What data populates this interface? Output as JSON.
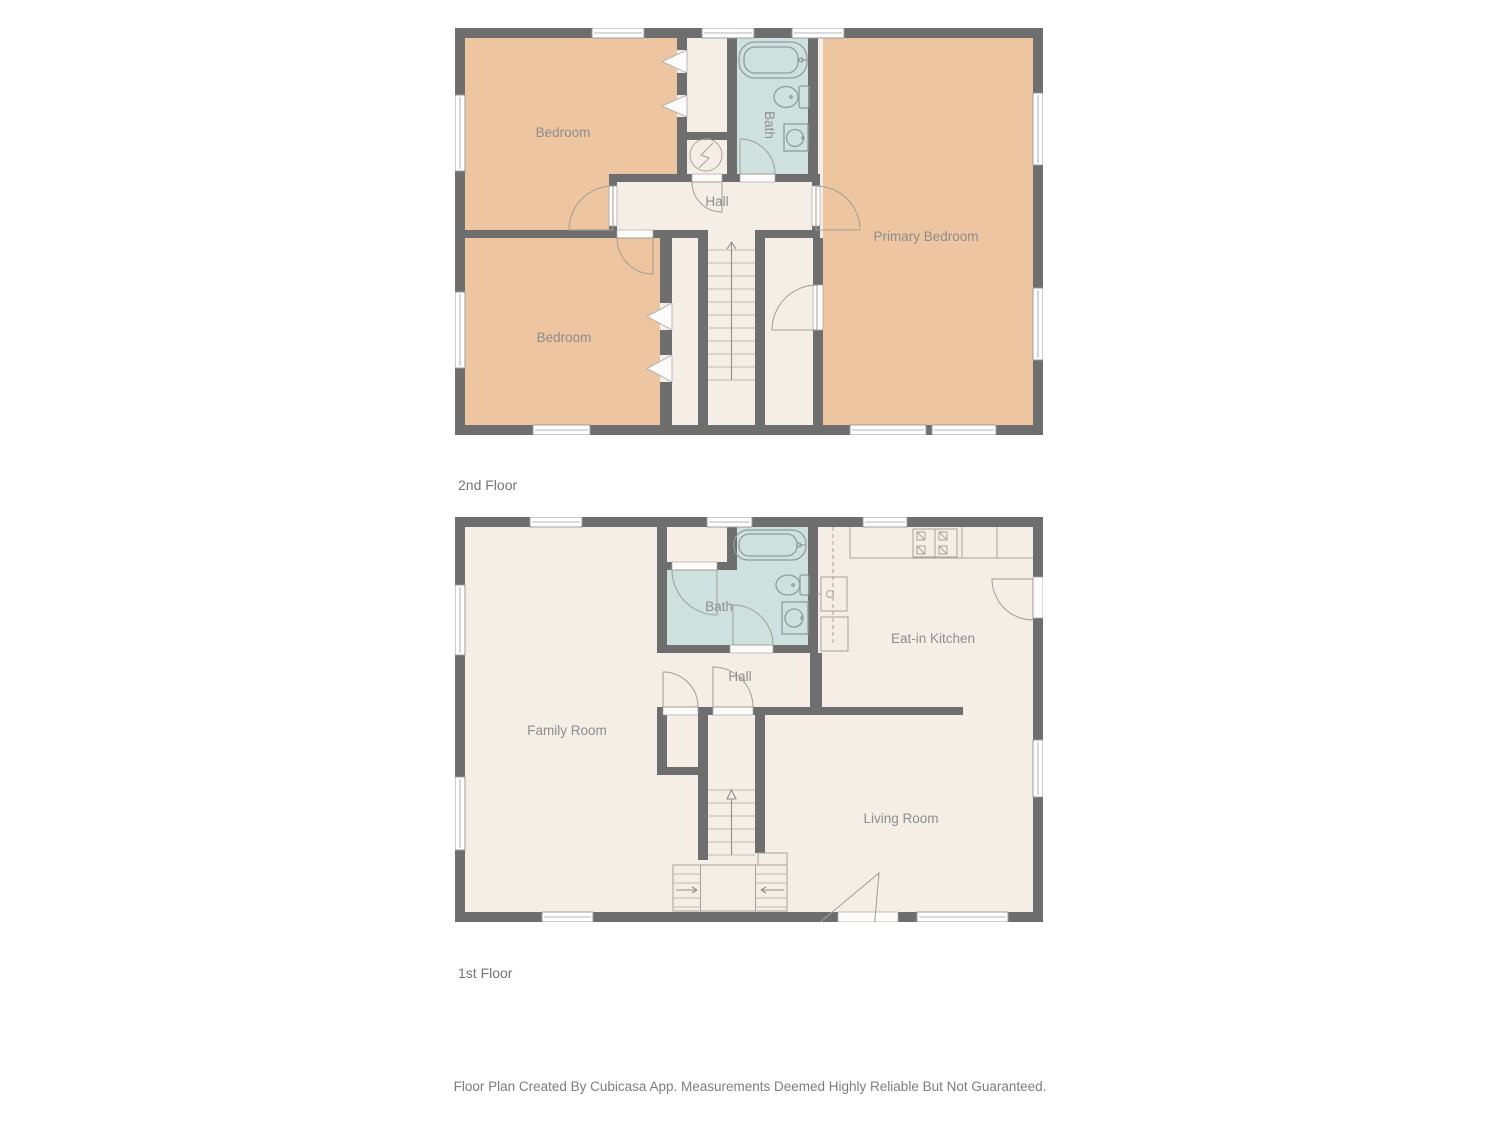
{
  "page": {
    "background": "#ffffff",
    "footer_disclaimer": "Floor Plan Created By Cubicasa App. Measurements Deemed Highly Reliable But Not Guaranteed."
  },
  "palette": {
    "wall": "#6e6e6e",
    "bedroom_fill": "#edc5a1",
    "floor_fill": "#f5eee7",
    "bath_fill": "#cfe1df",
    "label_text": "#8d8d8d",
    "title_text": "#757575"
  },
  "floors": [
    {
      "title": "2nd Floor",
      "rooms": {
        "bedroom_top": "Bedroom",
        "bedroom_bottom": "Bedroom",
        "primary_bedroom": "Primary Bedroom",
        "bath": "Bath",
        "hall": "Hall"
      }
    },
    {
      "title": "1st Floor",
      "rooms": {
        "family_room": "Family Room",
        "bath": "Bath",
        "hall": "Hall",
        "kitchen": "Eat-in Kitchen",
        "living_room": "Living Room"
      }
    }
  ]
}
